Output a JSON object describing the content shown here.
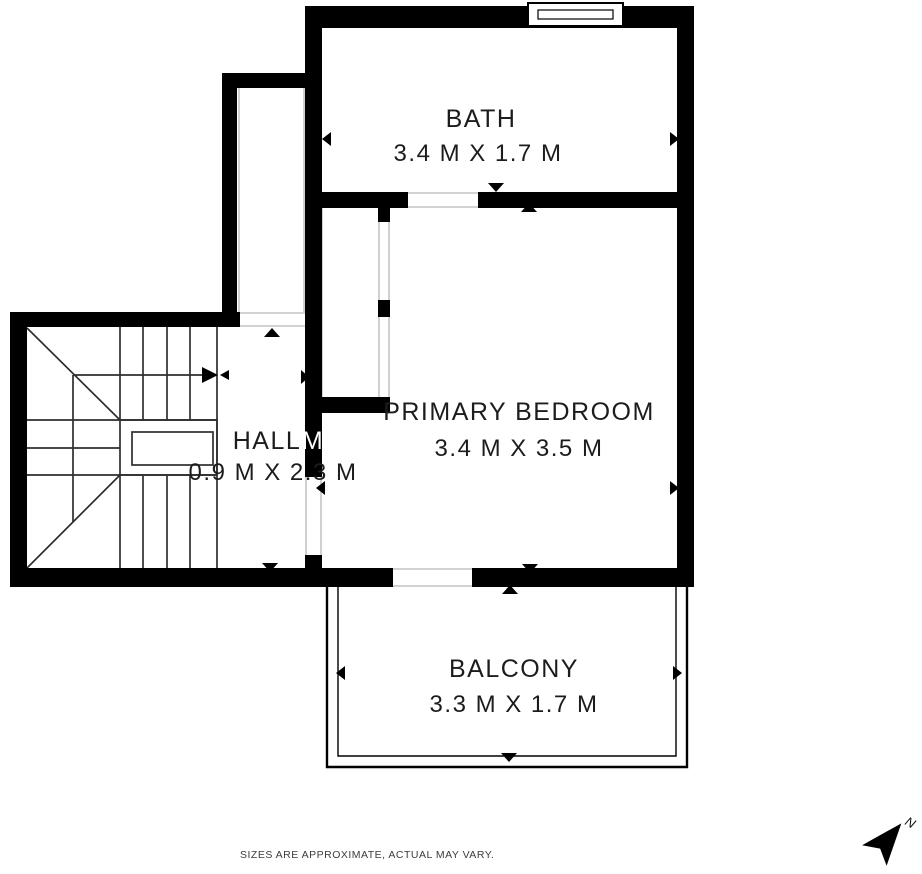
{
  "rooms": {
    "bath": {
      "name": "BATH",
      "dims": "3.4 M X 1.7 M"
    },
    "primary_bedroom": {
      "name": "PRIMARY BEDROOM",
      "dims": "3.4 M X 3.5 M"
    },
    "hall": {
      "name": "HALL",
      "wall_letter": "M",
      "dims": "0.9 M X 2.3 M"
    },
    "balcony": {
      "name": "BALCONY",
      "dims": "3.3 M X 1.7 M"
    }
  },
  "footer": {
    "disclaimer": "SIZES ARE APPROXIMATE, ACTUAL MAY VARY."
  },
  "compass": {
    "label": "N"
  },
  "colors": {
    "wall": "#000000",
    "background": "#ffffff",
    "text": "#1c1c1c"
  }
}
